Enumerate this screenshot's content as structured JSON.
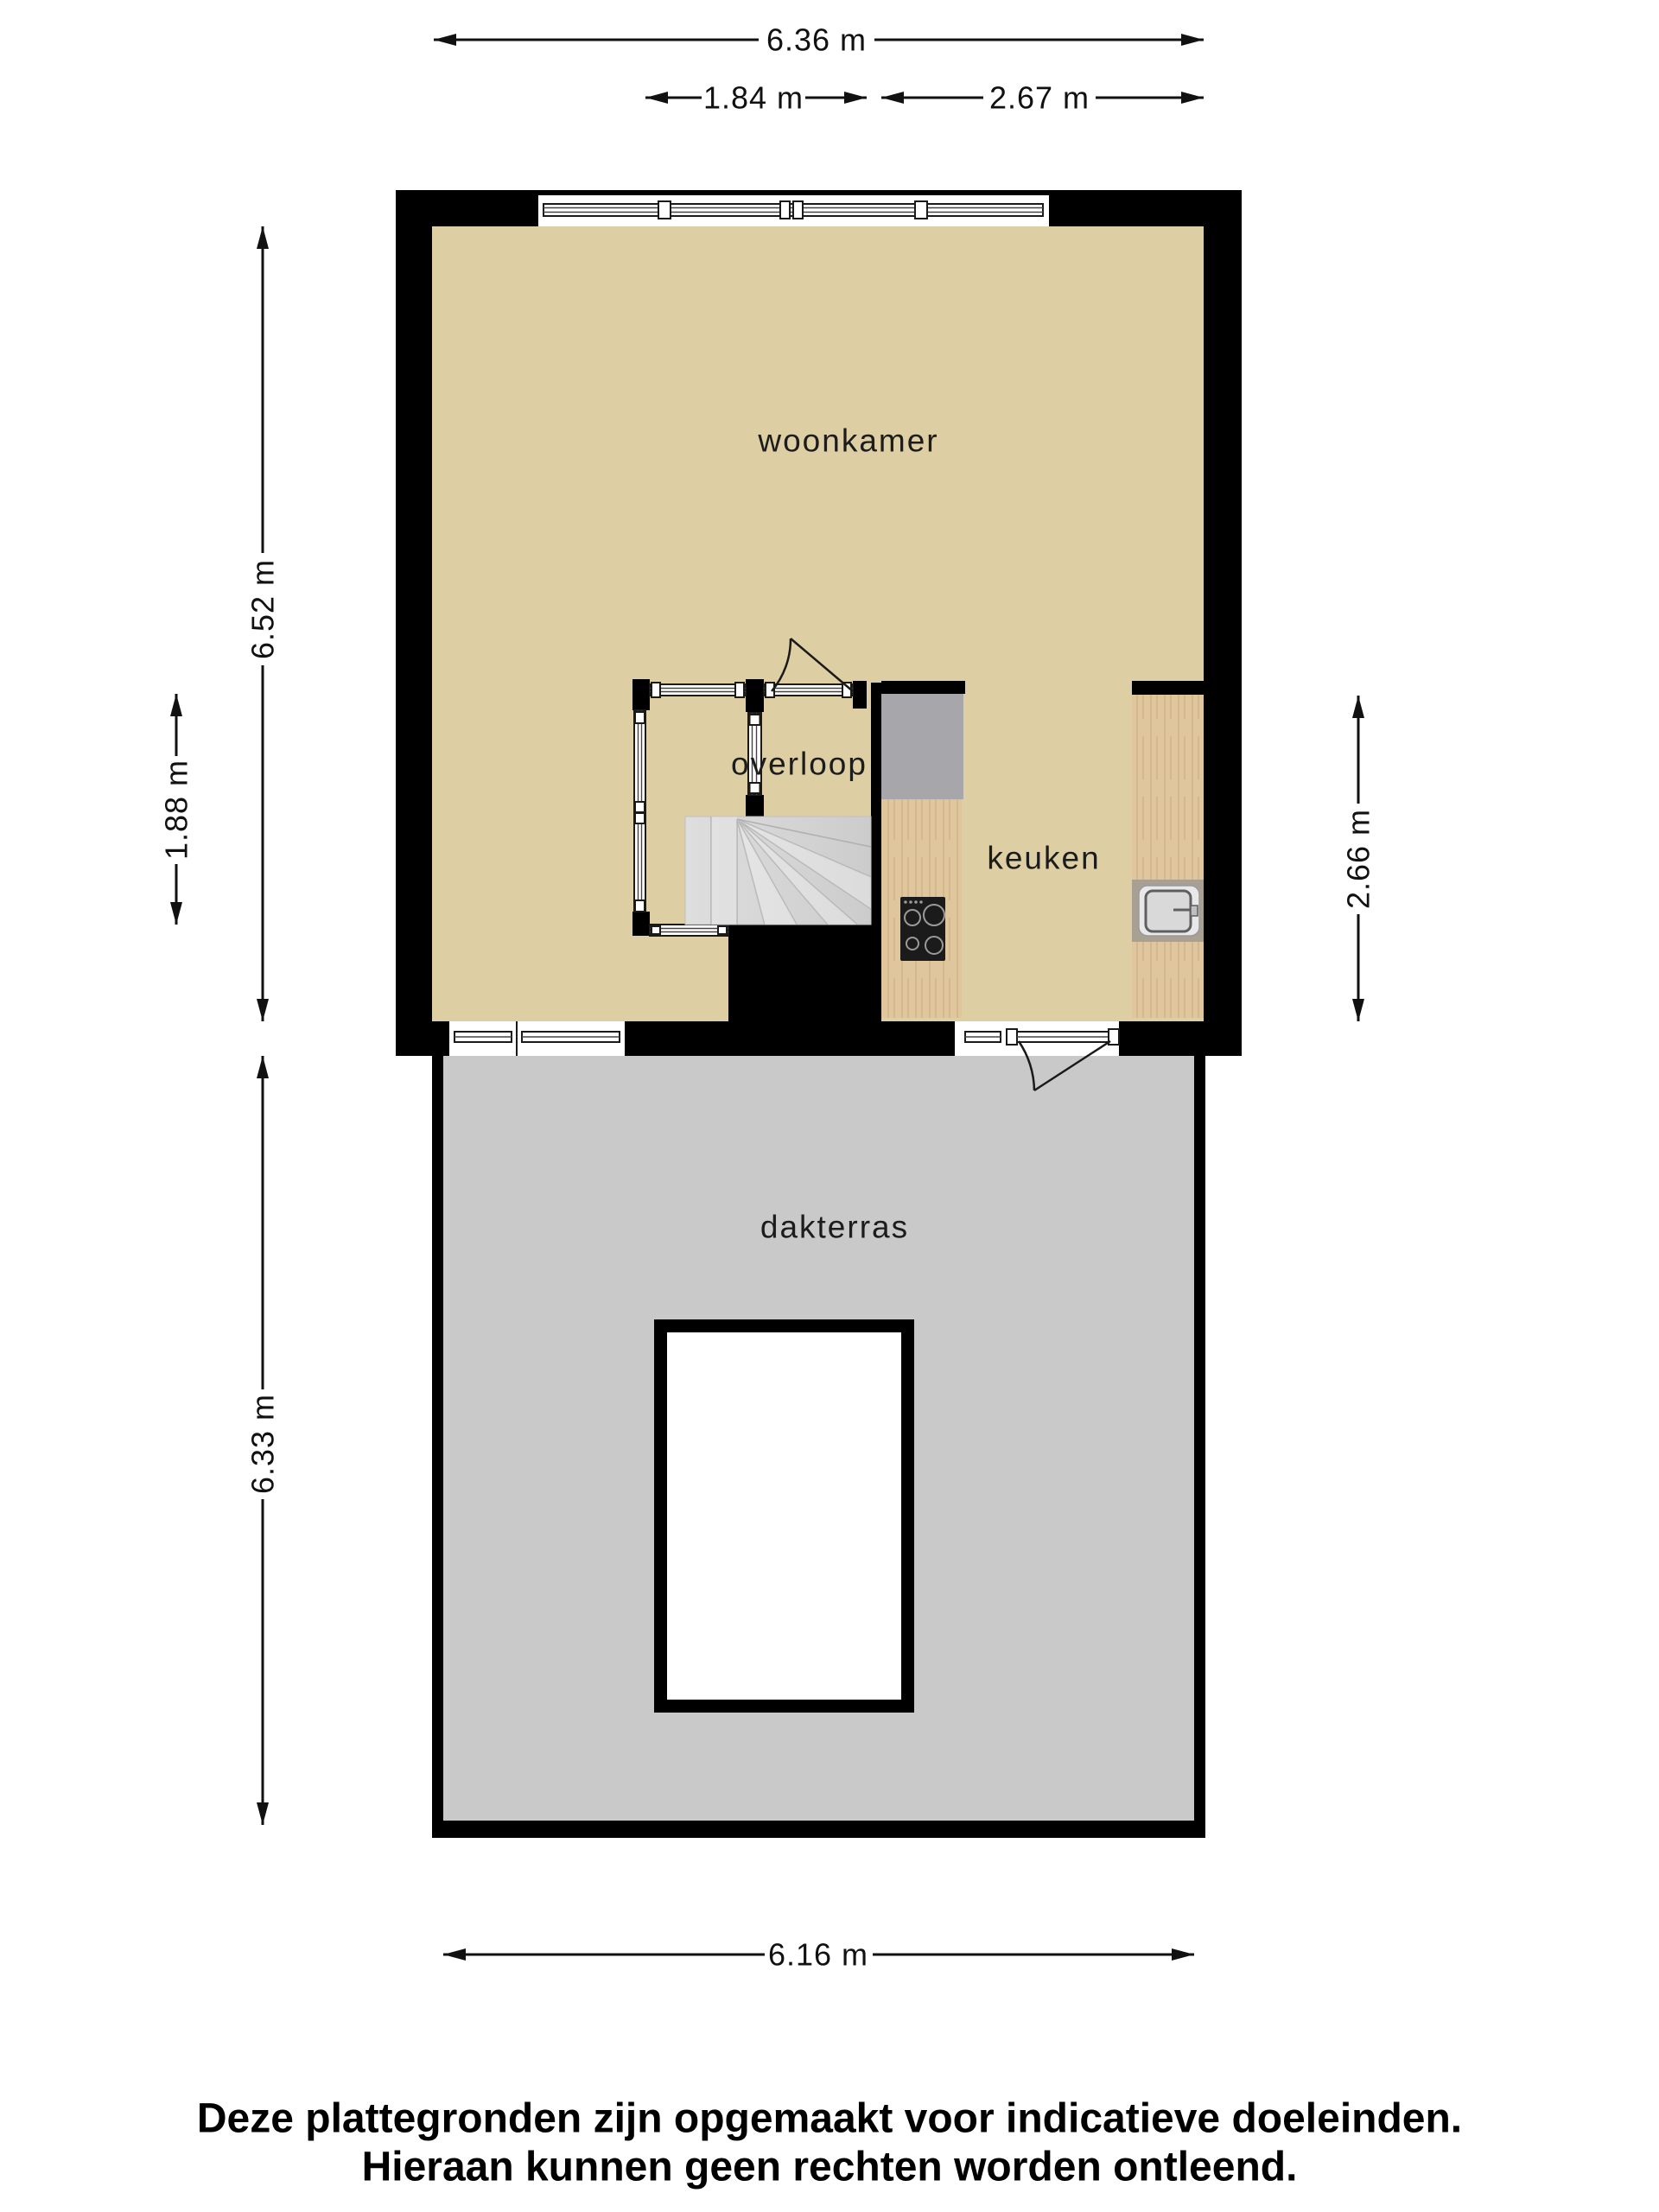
{
  "rooms": {
    "woonkamer": "woonkamer",
    "overloop": "overloop",
    "keuken": "keuken",
    "dakterras": "dakterras"
  },
  "dimensions": {
    "top_total": "6.36 m",
    "top_overloop": "1.84 m",
    "top_keuken": "2.67 m",
    "left_upper_floor": "6.52 m",
    "left_overloop": "1.88 m",
    "left_terrace": "6.33 m",
    "right_keuken": "2.66 m",
    "bottom_terrace": "6.16 m"
  },
  "disclaimer": {
    "line1": "Deze plattegronden zijn opgemaakt voor indicatieve doeleinden.",
    "line2": "Hieraan kunnen geen rechten worden ontleend."
  },
  "colors": {
    "wall": "#000000",
    "floor": "#DDCFA3",
    "terrace": "#C9C9C9",
    "stairs": "#D6D6D6",
    "counter_wood": "#DFC69C",
    "appliance_gray": "#A7A6AA",
    "sink_surround": "#A9A094",
    "cooktop": "#1B1B1B"
  },
  "fixtures": {
    "staircase": "winder-staircase",
    "cooktop": "four-burner-cooktop",
    "sink": "kitchen-sink",
    "doors": "door-swing-arc",
    "railing": "glass-balustrade"
  }
}
